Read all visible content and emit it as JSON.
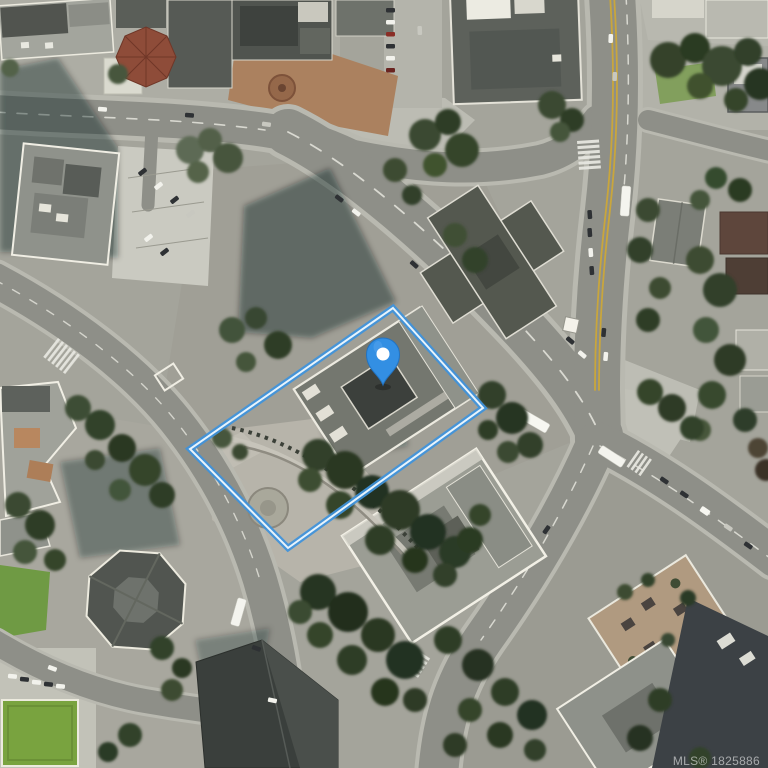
{
  "map": {
    "description": "Aerial satellite view of an urban block with highlighted property parcel",
    "watermark": "MLS® 1825886",
    "boundary": {
      "points": "393,308 483,408 288,548 190,449",
      "stroke": "#3E93DC",
      "core": "#E8F4FC"
    },
    "pin": {
      "transform": "translate(383,385)",
      "fill": "#338FE3",
      "dot_fill": "#FFFFFF"
    },
    "colors": {
      "accent_blue": "#3E93DC",
      "road": "#8E8F88",
      "sidewalk": "#BDBDB4",
      "tree_dark": "#2B3824",
      "grass": "#7AA23E",
      "roof_dark": "#50544F",
      "roof_trim": "#ECEAE0"
    }
  }
}
